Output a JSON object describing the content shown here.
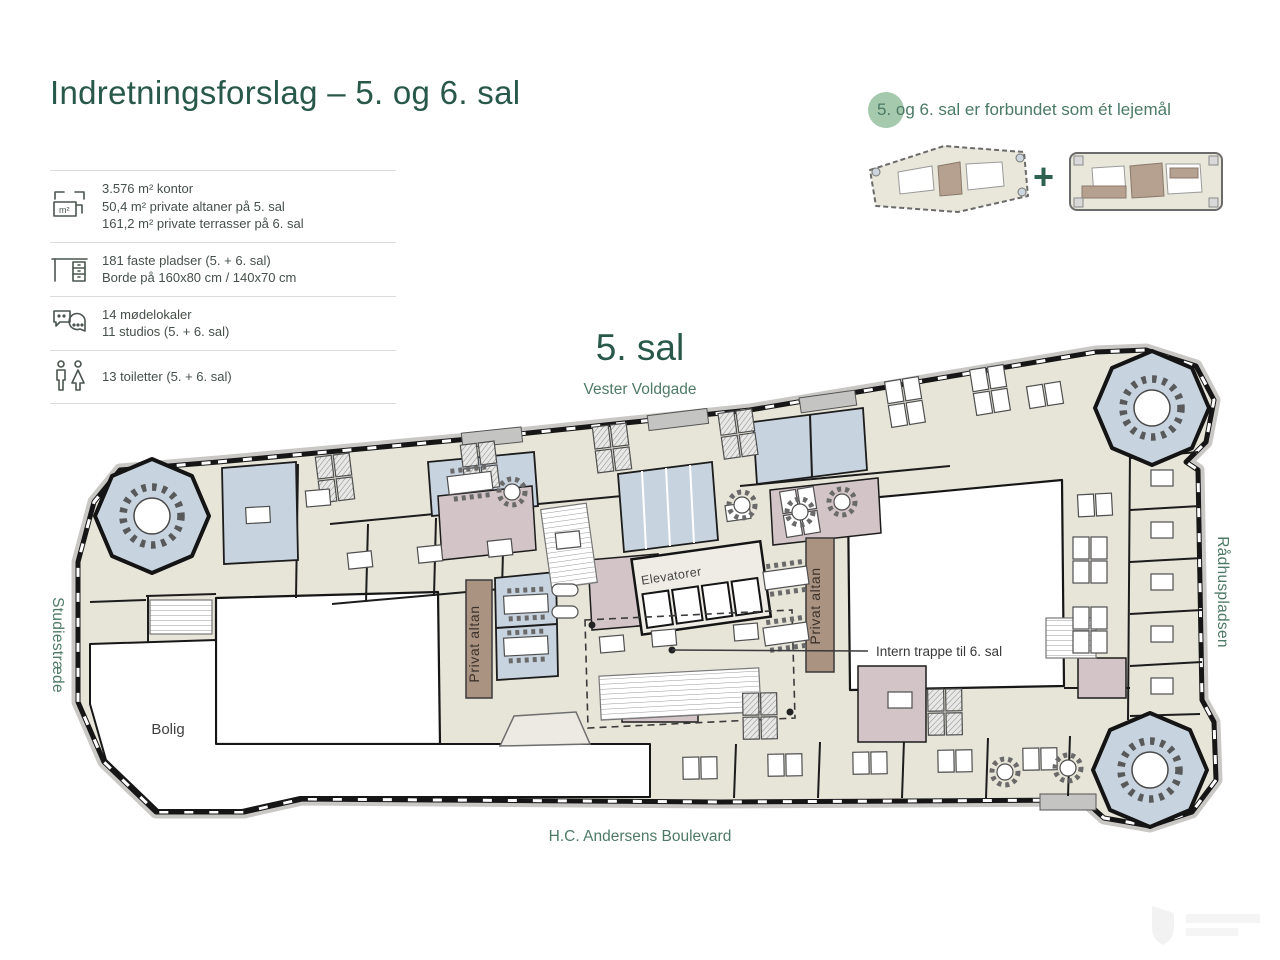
{
  "header": {
    "title": "Indretningsforslag – 5. og 6. sal"
  },
  "stats": {
    "rows": [
      {
        "icon": "area-icon",
        "lines": [
          "3.576 m² kontor",
          "50,4 m² private altaner på 5. sal",
          "161,2 m² private terrasser på 6. sal"
        ]
      },
      {
        "icon": "desk-icon",
        "lines": [
          "181 faste pladser (5. + 6. sal)",
          "Borde på 160x80 cm / 140x70 cm"
        ]
      },
      {
        "icon": "meeting-icon",
        "lines": [
          "14 mødelokaler",
          "11 studios (5. + 6. sal)"
        ]
      },
      {
        "icon": "toilet-icon",
        "lines": [
          "13 toiletter (5. + 6. sal)"
        ]
      }
    ]
  },
  "connection": {
    "text": "5. og 6. sal er forbundet som ét lejemål",
    "plus": "+"
  },
  "floor": {
    "label": "5. sal"
  },
  "streets": {
    "top": "Vester Voldgade",
    "left": "Studiestræde",
    "right": "Rådhuspladsen",
    "bottom": "H.C. Andersens Boulevard"
  },
  "plan_labels": {
    "elevators": "Elevatorer",
    "balcony": "Privat altan",
    "internal_stairs": "Intern trappe til 6. sal",
    "residence": "Bolig"
  },
  "colors": {
    "title_green": "#27584a",
    "street_green": "#4e7a67",
    "badge_green": "#a5c9ad",
    "office_beige": "#e7e4d8",
    "meeting_blue": "#c7d3df",
    "support_mauve": "#d2c4c7",
    "balcony_brown": "#ab9382",
    "wall_black": "#161616"
  }
}
